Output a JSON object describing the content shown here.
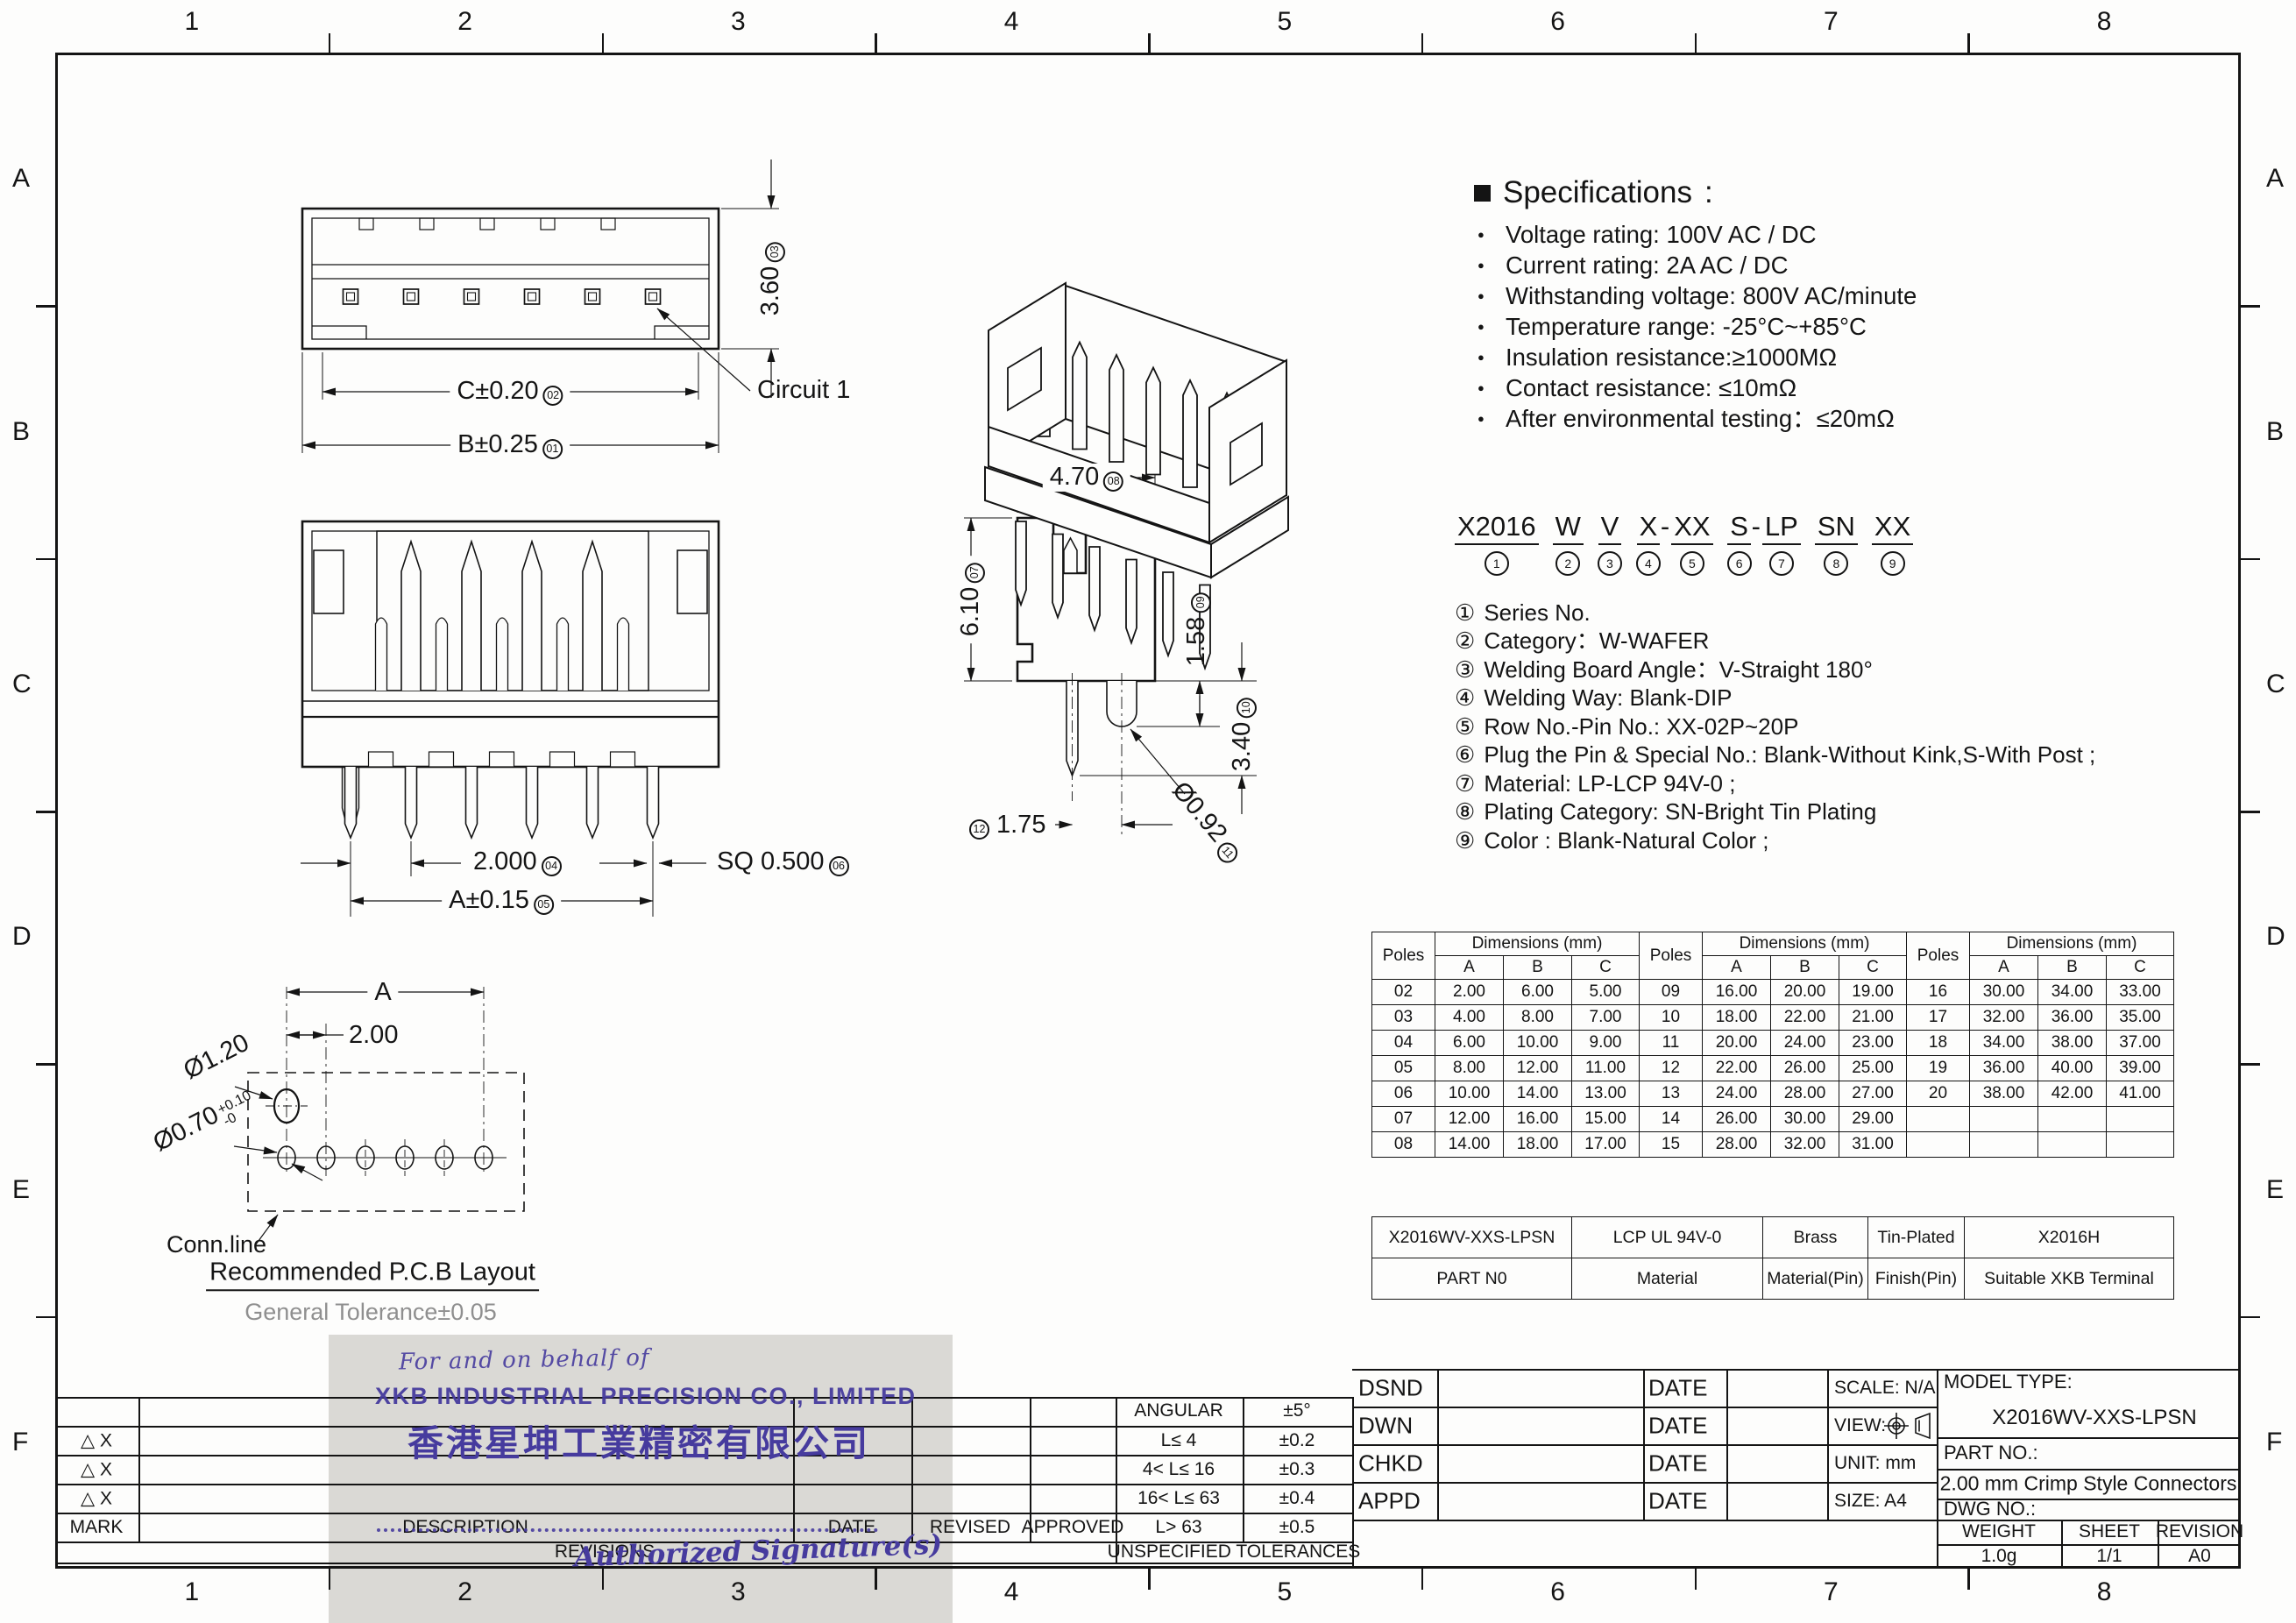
{
  "border": {
    "cols": [
      "1",
      "2",
      "3",
      "4",
      "5",
      "6",
      "7",
      "8"
    ],
    "rows": [
      "A",
      "B",
      "C",
      "D",
      "E",
      "F"
    ]
  },
  "colors": {
    "line": "#141414",
    "stamp_purple": "#463b9e",
    "stamp_bg": "#d7d6d2",
    "faded_gray": "#8f8f8f"
  },
  "specs": {
    "title": "Specifications",
    "colon": ":",
    "items": [
      "Voltage rating: 100V AC / DC",
      "Current rating: 2A  AC / DC",
      "Withstanding voltage: 800V AC/minute",
      "Temperature range: -25°C~+85°C",
      "Insulation resistance:≥1000MΩ",
      "Contact resistance: ≤10mΩ",
      "After environmental testing：≤20mΩ"
    ]
  },
  "part_number": {
    "tokens": [
      {
        "t": "X2016",
        "n": "1"
      },
      {
        "t": "W",
        "n": "2"
      },
      {
        "t": "V",
        "n": "3"
      },
      {
        "t": "X",
        "n": "4",
        "tight": true
      },
      {
        "sep": "-"
      },
      {
        "t": "XX",
        "n": "5"
      },
      {
        "t": "S",
        "n": "6",
        "tight": true
      },
      {
        "sep": "-"
      },
      {
        "t": "LP",
        "n": "7"
      },
      {
        "t": "SN",
        "n": "8"
      },
      {
        "t": "XX",
        "n": "9"
      }
    ],
    "legend": [
      {
        "num": "①",
        "text": "Series No."
      },
      {
        "num": "②",
        "text": "Category：W-WAFER"
      },
      {
        "num": "③",
        "text": "Welding Board Angle：V-Straight 180°"
      },
      {
        "num": "④",
        "text": "Welding Way:  Blank-DIP"
      },
      {
        "num": "⑤",
        "text": "Row No.-Pin No.:  XX-02P~20P"
      },
      {
        "num": "⑥",
        "text": "Plug the Pin & Special No.: Blank-Without Kink,S-With Post ;"
      },
      {
        "num": "⑦",
        "text": "Material:  LP-LCP 94V-0 ;"
      },
      {
        "num": "⑧",
        "text": "Plating Category:  SN-Bright Tin Plating"
      },
      {
        "num": "⑨",
        "text": "Color :  Blank-Natural Color ;"
      }
    ]
  },
  "views": {
    "top": {
      "b": "B±0.25",
      "b_no": "01",
      "c": "C±0.20",
      "c_no": "02",
      "h": "3.60",
      "h_no": "03",
      "circuit": "Circuit 1"
    },
    "front": {
      "pitch": "2.000",
      "pitch_no": "04",
      "a": "A±0.15",
      "a_no": "05",
      "sq": "SQ 0.500",
      "sq_no": "06"
    },
    "side": {
      "w": "4.70",
      "w_no": "08",
      "h": "6.10",
      "h_no": "07",
      "d1": "1.58",
      "d1_no": "09",
      "d2": "3.40",
      "d2_no": "10",
      "dia": "Ø0.92",
      "dia_no": "11",
      "off": "1.75",
      "off_no": "12"
    },
    "pcb": {
      "a": "A",
      "pitch": "2.00",
      "d1": "Ø1.20",
      "d2": "Ø0.70",
      "d2_tol_up": "+0.10",
      "d2_tol_dn": "-0",
      "conn": "Conn.line",
      "title": "Recommended P.C.B Layout",
      "tol": "General Tolerance±0.05"
    }
  },
  "dim_table": {
    "poles": "Poles",
    "dims": "Dimensions (mm)",
    "a": "A",
    "b": "B",
    "c": "C",
    "rows": [
      [
        "02",
        "2.00",
        "6.00",
        "5.00",
        "09",
        "16.00",
        "20.00",
        "19.00",
        "16",
        "30.00",
        "34.00",
        "33.00"
      ],
      [
        "03",
        "4.00",
        "8.00",
        "7.00",
        "10",
        "18.00",
        "22.00",
        "21.00",
        "17",
        "32.00",
        "36.00",
        "35.00"
      ],
      [
        "04",
        "6.00",
        "10.00",
        "9.00",
        "11",
        "20.00",
        "24.00",
        "23.00",
        "18",
        "34.00",
        "38.00",
        "37.00"
      ],
      [
        "05",
        "8.00",
        "12.00",
        "11.00",
        "12",
        "22.00",
        "26.00",
        "25.00",
        "19",
        "36.00",
        "40.00",
        "39.00"
      ],
      [
        "06",
        "10.00",
        "14.00",
        "13.00",
        "13",
        "24.00",
        "28.00",
        "27.00",
        "20",
        "38.00",
        "42.00",
        "41.00"
      ],
      [
        "07",
        "12.00",
        "16.00",
        "15.00",
        "14",
        "26.00",
        "30.00",
        "29.00",
        "",
        "",
        "",
        ""
      ],
      [
        "08",
        "14.00",
        "18.00",
        "17.00",
        "15",
        "28.00",
        "32.00",
        "31.00",
        "",
        "",
        "",
        ""
      ]
    ]
  },
  "part_table": {
    "rows": [
      [
        "X2016WV-XXS-LPSN",
        "LCP  UL 94V-0",
        "Brass",
        "Tin-Plated",
        "X2016H"
      ],
      [
        "PART N0",
        "Material",
        "Material(Pin)",
        "Finish(Pin)",
        "Suitable XKB Terminal"
      ]
    ]
  },
  "tolerance_table": {
    "rows": [
      [
        "ANGULAR",
        "±5°"
      ],
      [
        "L≤ 4",
        "±0.2"
      ],
      [
        "4< L≤ 16",
        "±0.3"
      ],
      [
        "16< L≤ 63",
        "±0.4"
      ],
      [
        "L> 63",
        "±0.5"
      ]
    ],
    "footer": "UNSPECIFIED  TOLERANCES"
  },
  "revision_block": {
    "mark_x": "△ X",
    "mark": "MARK",
    "description": "DESCRIPTION",
    "date": "DATE",
    "revised": "REVISED",
    "approved": "APPROVED",
    "revisions": "REVISIONS"
  },
  "title_block": {
    "dsnd": "DSND",
    "dwn": "DWN",
    "chkd": "CHKD",
    "appd": "APPD",
    "date": "DATE",
    "scale": "SCALE: N/A",
    "view": "VIEW:",
    "unit": "UNIT:  mm",
    "size": "SIZE:  A4",
    "model_type_label": "MODEL TYPE:",
    "model_type": "X2016WV-XXS-LPSN",
    "part_no_label": "PART NO.:",
    "product": "2.00 mm Crimp Style Connectors",
    "dwg_label": "DWG NO.:",
    "weight_label": "WEIGHT",
    "weight": "1.0g",
    "sheet_label": "SHEET",
    "sheet": "1/1",
    "revision_label": "REVISION",
    "revision": "A0"
  },
  "stamp": {
    "for_text": "For  and  on  behalf  of",
    "company_en": "XKB  INDUSTRIAL  PRECISION  CO.,  LIMITED",
    "company_cn": "香港星坤工業精密有限公司",
    "signature": "Authorized  Signature(s)"
  }
}
